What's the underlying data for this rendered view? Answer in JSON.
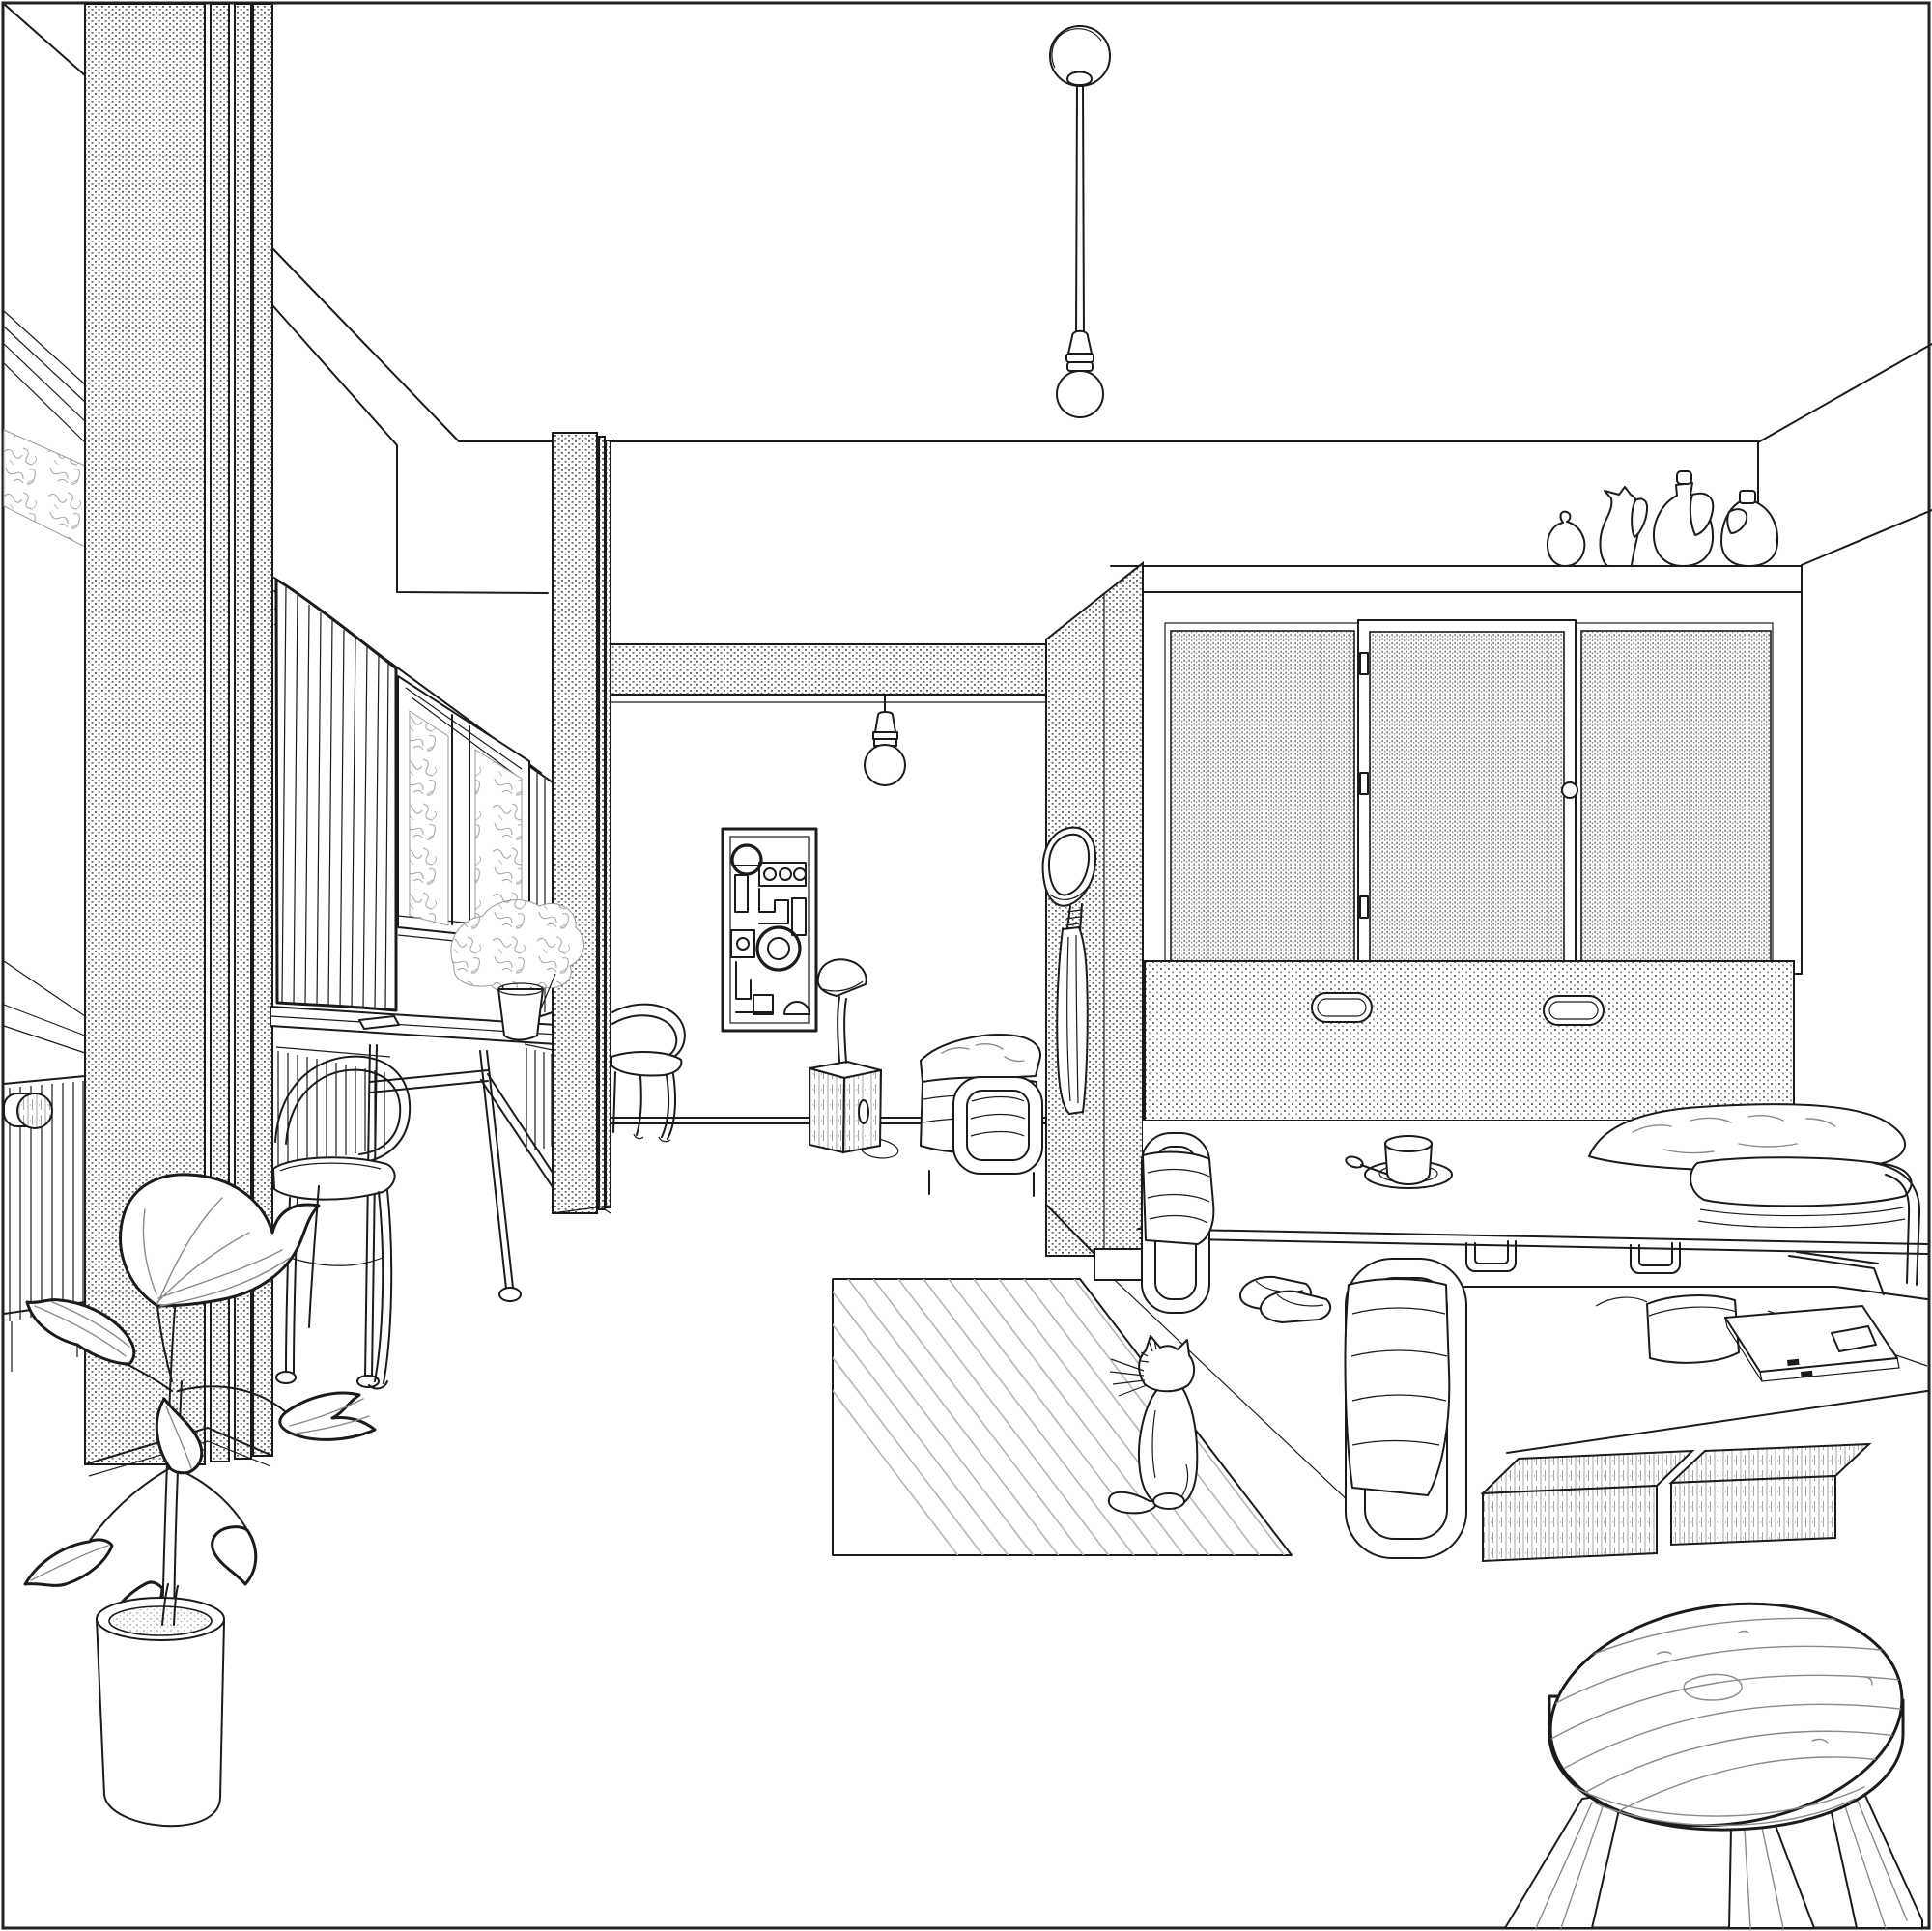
{
  "illustration": {
    "style": "black-and-white architectural interior line drawing, one-point-ish perspective",
    "palette": {
      "background": "#ffffff",
      "line": "#1b1b1b",
      "texture_gray": "#8a8a8a",
      "soft_gray": "#b5b5b5"
    },
    "scene": {
      "room": "studio apartment interior",
      "objects": {
        "border": "thin rectangular frame around the whole drawing",
        "pendant_lamp_large": "ceiling rose with long cord and bare round bulb, upper middle",
        "pendant_lamp_small": "short cord bare bulb hanging from hatched beam, centre",
        "pillar_left": "tall stippled pier with three narrow stippled mullion bands, left side, full height",
        "pillar_middle": "free-standing stippled pier in middle ground",
        "beam": "stippled transfer beam above centre of back wall",
        "partition_wall": "stippled partition forming sleeping alcove, hat and coat hung on it",
        "left_window": "tall window with tree foliage seen through glass, radiator below",
        "radiator_left": "column radiator with valve knob, bottom left",
        "bay_window": "window band with white drape curtain and sheer curtain",
        "curtain": "full-height pleated white curtain",
        "dining_table": "long thin-leg table under window with small book and flower vase",
        "flower_vase": "white vase with gray flower bouquet on table",
        "bentwood_chair_front": "Thonet-style hoop-back chair in foreground",
        "bentwood_chair_back": "Thonet-style hoop-back chair beside middle pier",
        "artwork": "framed abstract geometric print on back wall",
        "desk_lamp": "small dome lamp standing on wood-grain crate with cable loop",
        "crate": "wood-grain bedside crate with oval cut-out handle",
        "daybed_back": "tubular-steel daybed with bedding against back wall",
        "hat": "sun hat hanging on partition",
        "coat": "long coat hanging under the hat",
        "wardrobe": "built-in wardrobe with three cane/mesh sliding doors, knob and hinges",
        "vases_on_wardrobe": [
          "round vase with curled neck",
          "pitcher with spout and handle",
          "amphora with stopper and handle",
          "jug with cork and handle"
        ],
        "fold_down_bed_panel": "stippled headboard panel with two oval recessed handles",
        "bed_main": "wide bed with headrest tube frame, cup and saucer with spoon, big pillow and folded duvet",
        "cup_and_saucer": "cup on saucer with spoon on the bed deck",
        "under_bed_brackets": "two U-brackets and a wire bracket under the bed rail",
        "bed_lower": "pull-out lower bed with tubular frame, pencil case and clasp book on it",
        "storage_boxes": "two fine-hatched storage boxes under the pull-out bed",
        "slippers": "pair of slippers on the floor",
        "rug": "striped flat-weave rug, diagonal stripes",
        "cat": "cat sitting on the rug seen from behind, whiskers and curled tail",
        "plant": "large leafy potted plant in cylindrical pot, foreground left",
        "stool": "three-legged round wooden stool with wood grain, foreground right"
      }
    }
  }
}
